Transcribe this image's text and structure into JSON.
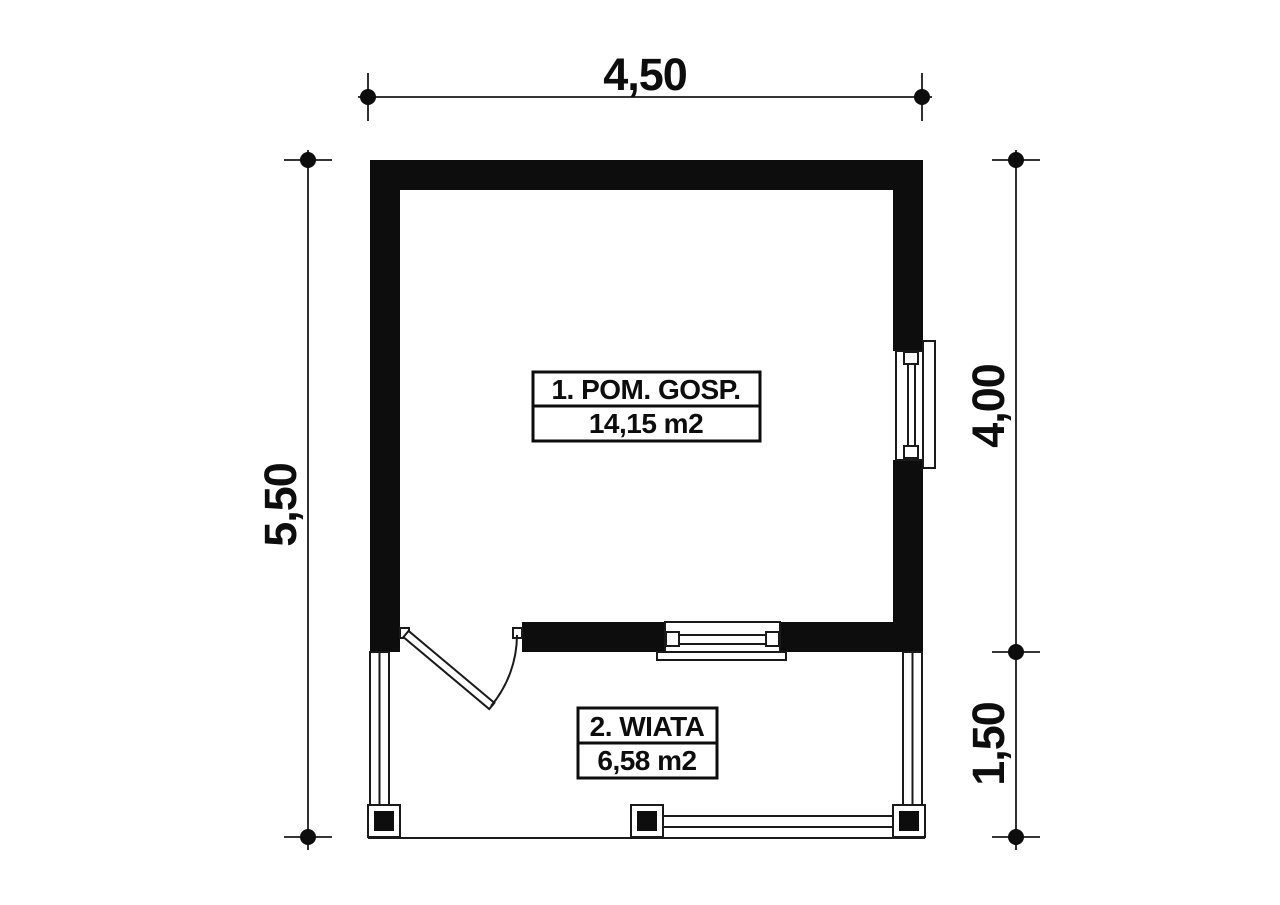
{
  "plan": {
    "colors": {
      "background": "#ffffff",
      "wall_fill": "#0d0d0d",
      "line": "#1a1a1a"
    },
    "rooms": [
      {
        "label": "1. POM. GOSP.",
        "area": "14,15 m2"
      },
      {
        "label": "2. WIATA",
        "area": "6,58 m2"
      }
    ],
    "dimensions": {
      "width_total": "4,50",
      "height_total": "5,50",
      "height_main": "4,00",
      "height_porch": "1,50"
    }
  }
}
